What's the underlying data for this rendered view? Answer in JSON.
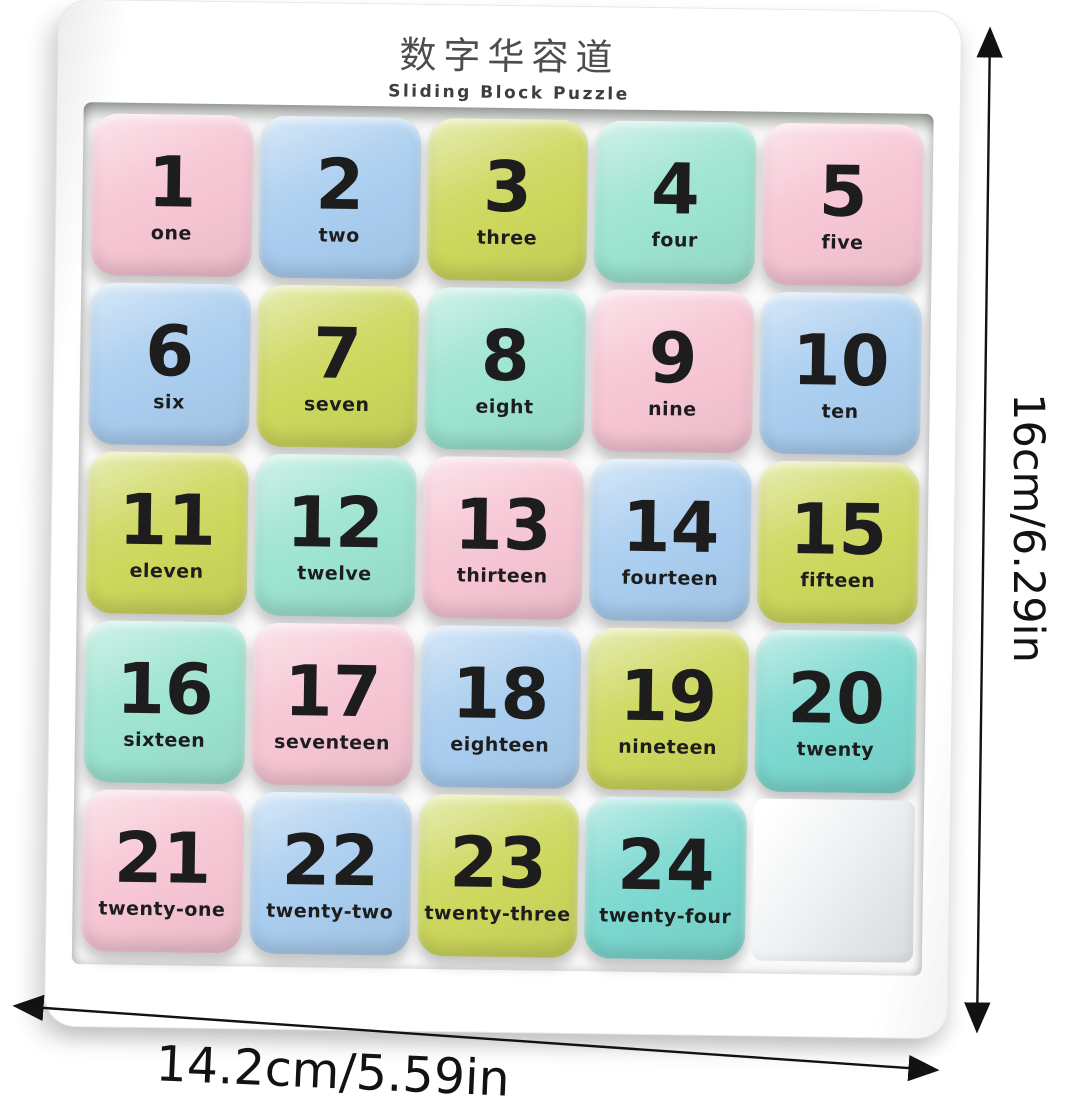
{
  "board": {
    "title_cn": "数字华容道",
    "title_en": "Sliding Block Puzzle"
  },
  "tiles": [
    {
      "number": "1",
      "word": "one",
      "color": "pink"
    },
    {
      "number": "2",
      "word": "two",
      "color": "blue"
    },
    {
      "number": "3",
      "word": "three",
      "color": "green"
    },
    {
      "number": "4",
      "word": "four",
      "color": "mint"
    },
    {
      "number": "5",
      "word": "five",
      "color": "pink"
    },
    {
      "number": "6",
      "word": "six",
      "color": "blue"
    },
    {
      "number": "7",
      "word": "seven",
      "color": "green"
    },
    {
      "number": "8",
      "word": "eight",
      "color": "mint"
    },
    {
      "number": "9",
      "word": "nine",
      "color": "pink"
    },
    {
      "number": "10",
      "word": "ten",
      "color": "blue"
    },
    {
      "number": "11",
      "word": "eleven",
      "color": "green"
    },
    {
      "number": "12",
      "word": "twelve",
      "color": "mint"
    },
    {
      "number": "13",
      "word": "thirteen",
      "color": "pink"
    },
    {
      "number": "14",
      "word": "fourteen",
      "color": "blue"
    },
    {
      "number": "15",
      "word": "fifteen",
      "color": "green"
    },
    {
      "number": "16",
      "word": "sixteen",
      "color": "mint"
    },
    {
      "number": "17",
      "word": "seventeen",
      "color": "pink"
    },
    {
      "number": "18",
      "word": "eighteen",
      "color": "blue"
    },
    {
      "number": "19",
      "word": "nineteen",
      "color": "green"
    },
    {
      "number": "20",
      "word": "twenty",
      "color": "teal"
    },
    {
      "number": "21",
      "word": "twenty-one",
      "color": "pink"
    },
    {
      "number": "22",
      "word": "twenty-two",
      "color": "blue"
    },
    {
      "number": "23",
      "word": "twenty-three",
      "color": "green"
    },
    {
      "number": "24",
      "word": "twenty-four",
      "color": "teal"
    }
  ],
  "empty_slot": {
    "position": "bottom-right"
  },
  "colors": {
    "pink": "#f6c5d3",
    "blue": "#a9cdef",
    "green": "#ccd75c",
    "mint": "#9ce3d0",
    "teal": "#7bd8cf",
    "tile_text": "#1d1d1d",
    "frame": "#ffffff",
    "annotation": "#121212"
  },
  "dimensions": {
    "height_label": "16cm/6.29in",
    "width_label": "14.2cm/5.59in"
  }
}
